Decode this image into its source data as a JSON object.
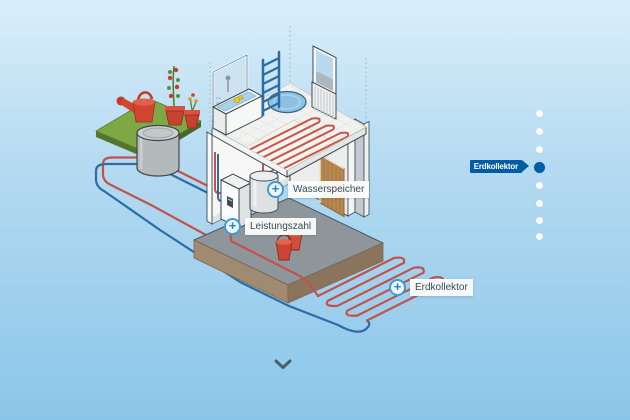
{
  "callouts": [
    {
      "id": "wasserspeicher",
      "label": "Wasserspeicher"
    },
    {
      "id": "leistungszahl",
      "label": "Leistungszahl"
    },
    {
      "id": "erdkollektor",
      "label": "Erdkollektor"
    }
  ],
  "nav": {
    "dots": 8,
    "active_index": 4,
    "active_label": "Erdkollektor"
  },
  "icons": {
    "plus": "+"
  },
  "colors": {
    "background_top": "#d9eefa",
    "background_bottom": "#8ac6e9",
    "nav_active_blue": "#005da5",
    "pipe_warm_red": "#c0544b",
    "pipe_cold_blue": "#2d6ca4",
    "callout_ring_blue": "#3f9bd3",
    "soil_brown": "#a08a71",
    "grass_green": "#7ea844"
  }
}
